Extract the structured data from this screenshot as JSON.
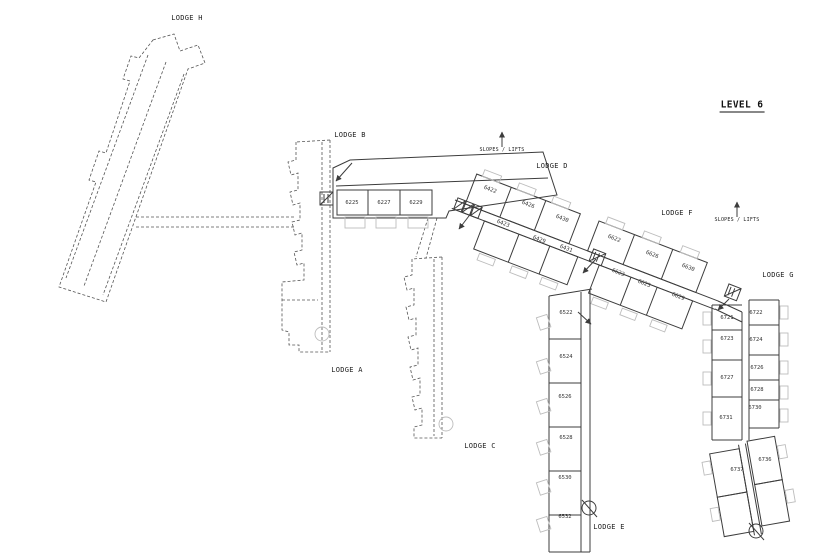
{
  "level_title": "LEVEL 6",
  "annotations": {
    "slopes_lifts_d": "SLOPES / LIFTS",
    "slopes_lifts_f": "SLOPES / LIFTS"
  },
  "lodges": {
    "h": {
      "label": "LODGE H"
    },
    "a": {
      "label": "LODGE A"
    },
    "b": {
      "label": "LODGE B",
      "rooms": [
        "6225",
        "6227",
        "6229"
      ]
    },
    "c": {
      "label": "LODGE C"
    },
    "d": {
      "label": "LODGE D",
      "rooms_top": [
        "6422",
        "6426",
        "6430"
      ],
      "rooms_bottom": [
        "6423",
        "6429",
        "6431"
      ]
    },
    "f": {
      "label": "LODGE F",
      "rooms_top": [
        "6622",
        "6626",
        "6630"
      ],
      "rooms_bottom": [
        "6623",
        "6625",
        "6629"
      ]
    },
    "e": {
      "label": "LODGE E",
      "rooms": [
        "6522",
        "6524",
        "6526",
        "6528",
        "6530",
        "6532"
      ]
    },
    "g": {
      "label": "LODGE G",
      "rooms_left": [
        "6721",
        "6723",
        "6727",
        "6731",
        "6737"
      ],
      "rooms_right": [
        "6722",
        "6724",
        "6726",
        "6728",
        "6730",
        "6736"
      ]
    }
  },
  "icons": {
    "lift_b": "lift-icon",
    "lift_bank_d": "triple-lift-icon",
    "lift_f": "lift-icon",
    "lift_g": "lift-icon",
    "stairs_e": "spiral-stair-icon",
    "stairs_g": "spiral-stair-icon",
    "slopes_arrows": "up-arrow-icon",
    "entrance_arrows": "direction-arrow-icon"
  },
  "colors": {
    "line": "#3c3c3c",
    "line_dashed": "#555555",
    "line_light": "#bdbdbd",
    "text": "#222222",
    "background": "#ffffff"
  }
}
